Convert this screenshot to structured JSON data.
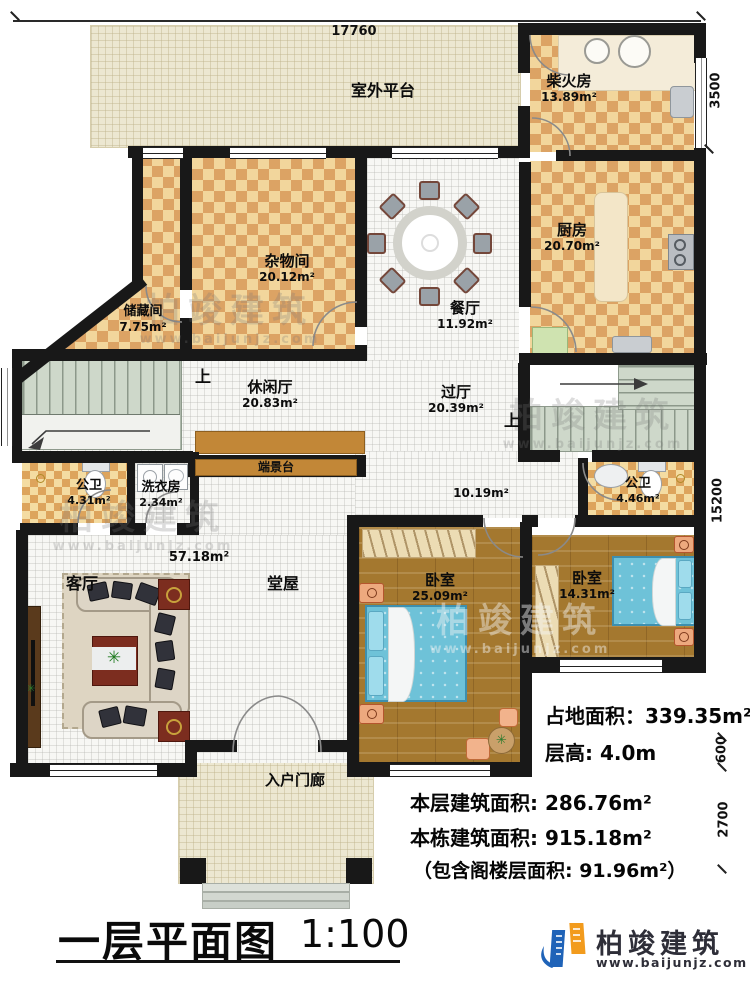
{
  "dimensions": {
    "top": "17760",
    "right_top": "3500",
    "right_mid": "15200",
    "right_b1": "600",
    "right_b2": "2700"
  },
  "rooms": {
    "outdoor_platform": {
      "label": "室外平台"
    },
    "firewood": {
      "label": "柴火房",
      "area": "13.89m²"
    },
    "kitchen": {
      "label": "厨房",
      "area": "20.70m²"
    },
    "sundry": {
      "label": "杂物间",
      "area": "20.12m²"
    },
    "storage": {
      "label": "储藏间",
      "area": "7.75m²"
    },
    "dining": {
      "label": "餐厅",
      "area": "11.92m²"
    },
    "leisure": {
      "label": "休闲厅",
      "area": "20.83m²"
    },
    "hallway": {
      "label": "过厅",
      "area": "20.39m²"
    },
    "console": {
      "label": "端景台"
    },
    "bath_left": {
      "label": "公卫",
      "area": "4.31m²"
    },
    "laundry": {
      "label": "洗衣房",
      "area": "2.34m²"
    },
    "bath_right": {
      "label": "公卫",
      "area": "4.46m²"
    },
    "corridor": {
      "area": "10.19m²"
    },
    "main_hall": {
      "label": "堂屋",
      "area": "57.18m²"
    },
    "living": {
      "label": "客厅"
    },
    "bedroom_left": {
      "label": "卧室",
      "area": "25.09m²"
    },
    "bedroom_right": {
      "label": "卧室",
      "area": "14.31m²"
    },
    "porch": {
      "label": "入户门廊"
    }
  },
  "stairs": {
    "up_left": "上",
    "up_right": "上"
  },
  "info": {
    "land_area": "占地面积：339.35m²",
    "floor_height": "层高: 4.0m",
    "floor_area": "本层建筑面积: 286.76m²",
    "total_area": "本栋建筑面积: 915.18m²",
    "attic_area": "（包含阁楼层面积: 91.96m²）"
  },
  "titleblock": {
    "title": "一层平面图",
    "scale": "1:100"
  },
  "brand": {
    "name": "柏竣建筑",
    "url": "www.baijunjz.com"
  },
  "watermark": {
    "name": "柏竣建筑",
    "url": "www.baijunjz.com"
  },
  "colors": {
    "wall": "#181818",
    "checker_dark": "#dca364",
    "checker_light": "#f2d69c",
    "wood": "#a4782f",
    "stair": "#ced8ca",
    "bed": "#6ec2d8",
    "console": "#c28737",
    "brand_blue": "#1f63b8",
    "brand_orange": "#f29b1d"
  }
}
